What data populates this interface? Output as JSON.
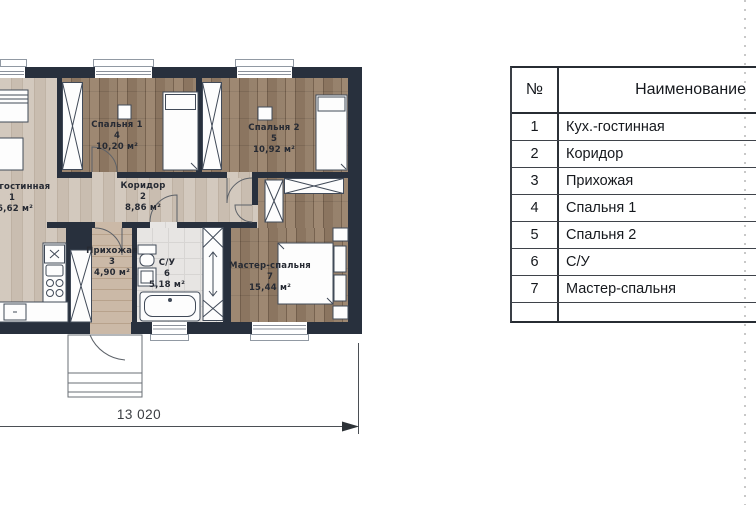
{
  "plan": {
    "rooms": [
      {
        "name": "Кух.-гостинная",
        "num": "1",
        "area": "26,62 м²"
      },
      {
        "name": "Коридор",
        "num": "2",
        "area": "8,86 м²"
      },
      {
        "name": "Прихожая",
        "num": "3",
        "area": "4,90 м²"
      },
      {
        "name": "Спальня 1",
        "num": "4",
        "area": "10,20 м²"
      },
      {
        "name": "Спальня 2",
        "num": "5",
        "area": "10,92 м²"
      },
      {
        "name": "С/У",
        "num": "6",
        "area": "5,18 м²"
      },
      {
        "name": "Мастер-спальня",
        "num": "7",
        "area": "15,44 м²"
      }
    ],
    "dimension_label": "13 020"
  },
  "table": {
    "header": {
      "num": "№",
      "name": "Наименование"
    },
    "rows": [
      {
        "num": "1",
        "name": "Кух.-гостинная"
      },
      {
        "num": "2",
        "name": "Коридор"
      },
      {
        "num": "3",
        "name": "Прихожая"
      },
      {
        "num": "4",
        "name": "Спальня 1"
      },
      {
        "num": "5",
        "name": "Спальня 2"
      },
      {
        "num": "6",
        "name": "С/У"
      },
      {
        "num": "7",
        "name": "Мастер-спальня"
      },
      {
        "num": "",
        "name": ""
      }
    ]
  },
  "colors": {
    "wall": "#28303d",
    "floor_light_wood": "#c9bdb0",
    "floor_dark_wood": "#8b7560",
    "floor_hall_wood": "#c2ad98",
    "floor_tile": "#e7e5e3",
    "furniture_line": "#414a58",
    "dimension_line": "#4b4f55",
    "margin_dash": "#c8c8c8"
  }
}
